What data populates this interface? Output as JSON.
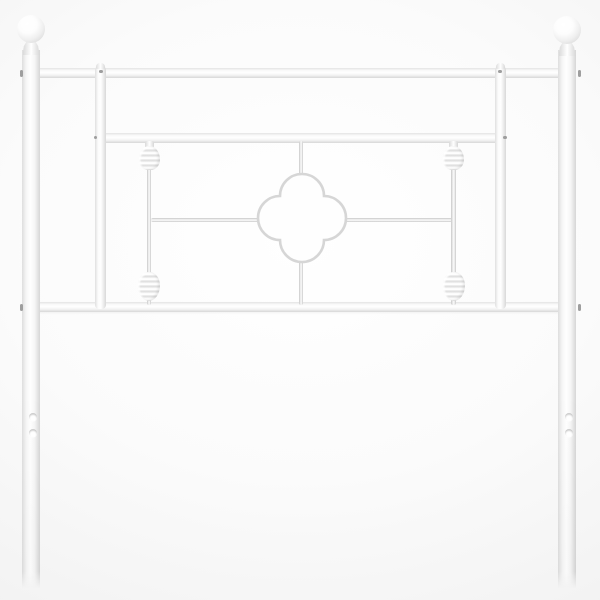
{
  "scene": {
    "description": "Product photo of a white metal bed headboard with ball finials, two ribbed spindles and a quatrefoil center ornament on a light studio background"
  },
  "colors": {
    "bg_center": "#ffffff",
    "bg_edge": "#ededed",
    "metal_base": "#fdfdfd",
    "metal_edge": "#d6d6d6",
    "rod_edge": "#c7c7c7",
    "outline": "#d6d6d6",
    "screw": "#9e9e9e"
  },
  "parts": {
    "top_rail": "Top rail",
    "middle_rail": "Middle rail",
    "bottom_rail": "Bottom rail",
    "left_post": "Left post",
    "right_post": "Right post",
    "left_finial": "Left ball finial",
    "right_finial": "Right ball finial",
    "left_inner_bar": "Left inner vertical bar",
    "right_inner_bar": "Right inner vertical bar",
    "left_spindle": "Left spindle rod",
    "right_spindle": "Right spindle rod",
    "knob": "Ribbed decorative knob",
    "quatrefoil": "Quatrefoil center ornament",
    "connector_rod": "Thin connector rod",
    "mounting_hole": "Mounting hole",
    "screw": "Fastening screw"
  }
}
